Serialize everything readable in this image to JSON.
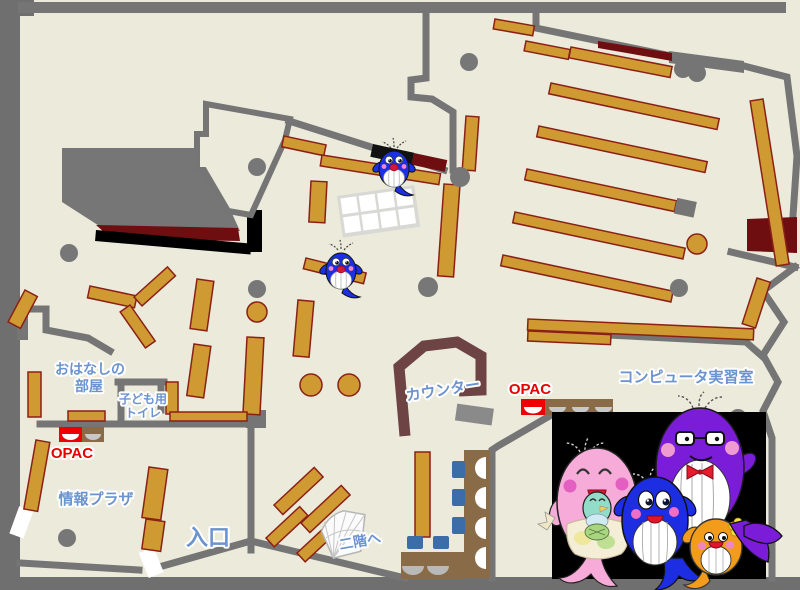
{
  "map": {
    "title": "library-first-floor-map",
    "labels": {
      "storyRoomLine1": "おはなしの",
      "storyRoomLine2": "部屋",
      "kidsToiletLine1": "子ども用",
      "kidsToiletLine2": "トイレ",
      "opac1": "OPAC",
      "opac2": "OPAC",
      "infoPlaza": "情報プラザ",
      "entrance": "入口",
      "counter": "カウンター",
      "computerRoom": "コンピュータ実習室",
      "stairsUp": "二階へ"
    },
    "colors": {
      "floor": "#ebeadb",
      "wall": "#757575",
      "shelf": "#d09a33",
      "shelfBorder": "#8b2017",
      "accentDarkRed": "#6e0e10",
      "counter": "#6d4343",
      "labelBlue": "#6b93cf",
      "labelRed": "#e60000",
      "chairBlue": "#3c6da9",
      "deskBrown": "#8a6b48",
      "opacRed": "#ee0000",
      "mascotPink": "#f6abd9",
      "mascotBlue": "#1d2de2",
      "mascotPurple": "#7b1cd9",
      "mascotOrange": "#f39c1b",
      "mascotPanel": "#000000"
    },
    "icons": [
      "whale-mascot-icon",
      "opac-terminal-icon",
      "stairs-icon",
      "pillar-icon",
      "round-table-icon"
    ]
  }
}
